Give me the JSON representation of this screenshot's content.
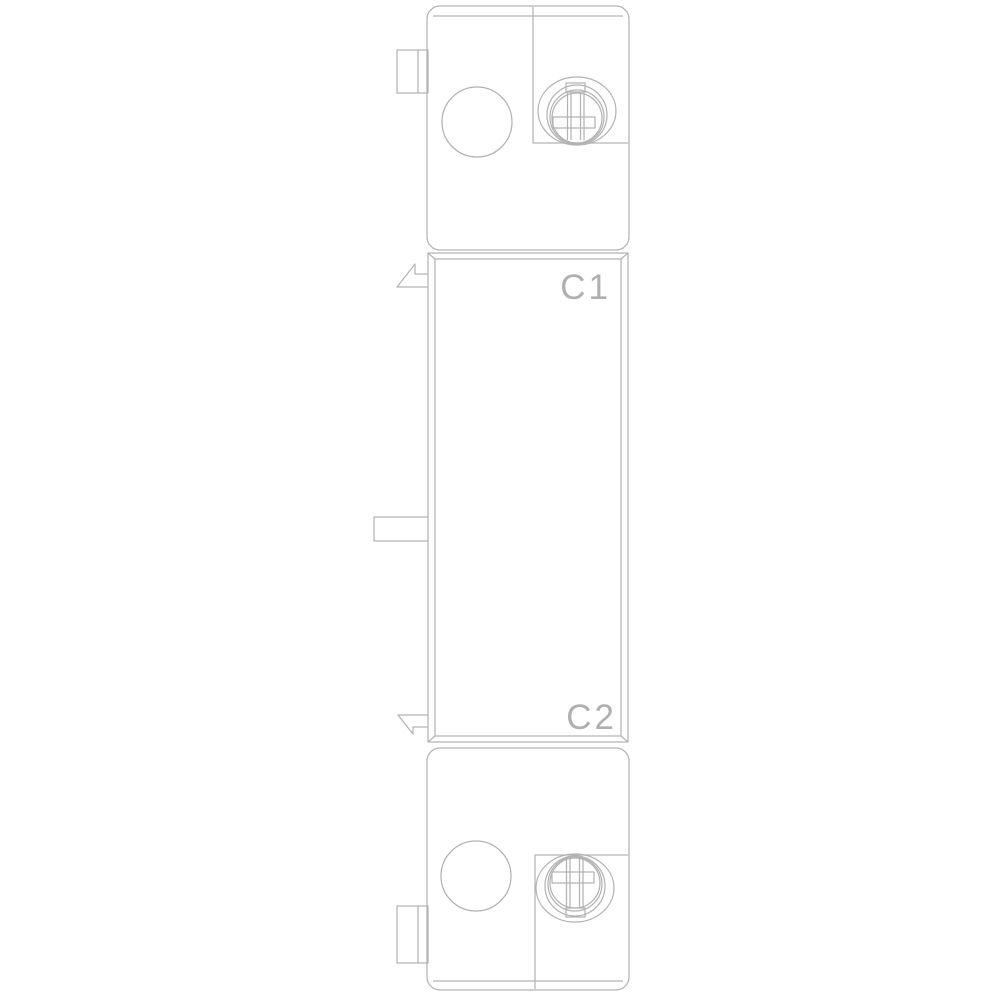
{
  "colors": {
    "line": "#b3b3b3",
    "label": "#b0b0b0",
    "background": "#ffffff"
  },
  "drawing": {
    "terminal_labels": {
      "top": "C1",
      "bottom": "C2"
    }
  }
}
